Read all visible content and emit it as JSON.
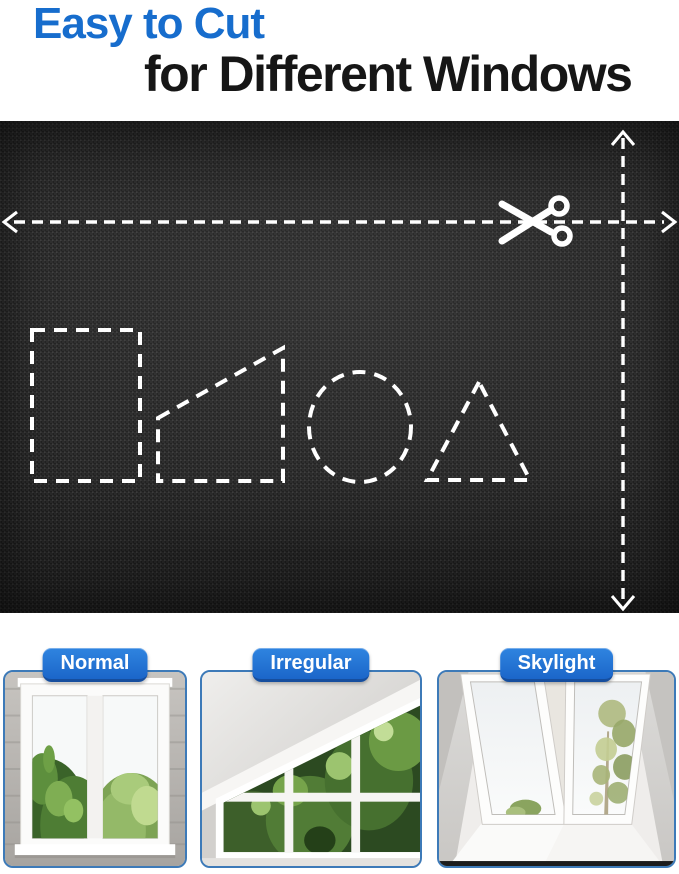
{
  "title": {
    "line1": "Easy to Cut",
    "line2": "for Different Windows"
  },
  "fabric_panel": {
    "cut_shapes": [
      "rectangle",
      "trapezoid",
      "circle",
      "triangle"
    ],
    "icons": [
      "scissors-icon",
      "horizontal-cut-arrow",
      "vertical-cut-arrow"
    ]
  },
  "cards": [
    {
      "label": "Normal"
    },
    {
      "label": "Irregular"
    },
    {
      "label": "Skylight"
    }
  ],
  "colors": {
    "accent_blue": "#176dcd",
    "pill_blue_top": "#2f84e0",
    "pill_blue_bottom": "#1b66c9",
    "title_text": "#161616",
    "fabric_black": "#1f1f1f",
    "dash_white": "#ffffff",
    "card_border": "#3d7ab8"
  }
}
